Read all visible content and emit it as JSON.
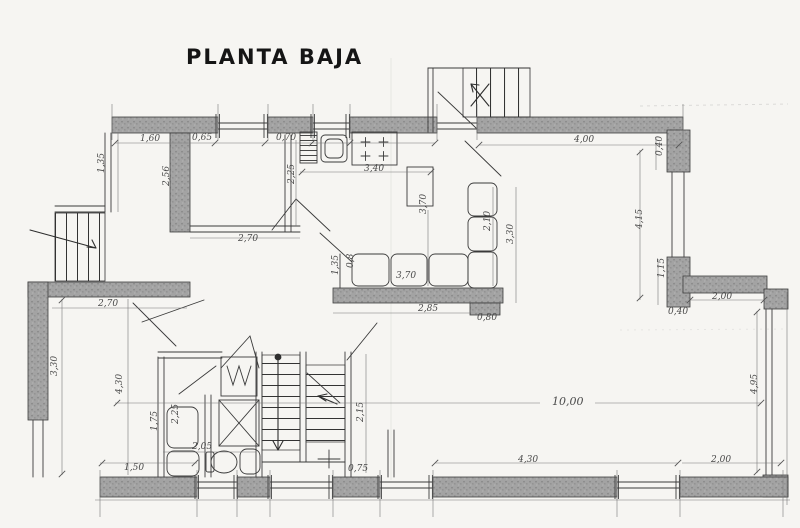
{
  "title": "PLANTA BAJA",
  "drawing": {
    "type": "floor-plan-sketch",
    "floor_label": "PLANTA BAJA",
    "units": "meters (comma decimals)"
  },
  "colors": {
    "paper": "#f6f5f2",
    "ink": "#3a3a3a",
    "wall": "#9b9b9b",
    "dim": "#4a4a4a"
  },
  "labels": {
    "t_1_60": "1,60",
    "t_0_65": "0,65",
    "t_0_70": "0,70",
    "k_3_40": "3,40",
    "t_4_00": "4,00",
    "l_1_35": "1,35",
    "w_2_56": "2,56",
    "k_2_25": "2,25",
    "k_3_70": "3,70",
    "h_2_70": "2,70",
    "s_3_70": "3,70",
    "s_0_80": "0,8",
    "s_1_35": "1,35",
    "d_2_10": "2,10",
    "d_3_30": "3,30",
    "m_2_85": "2,85",
    "m_0_80": "0,80",
    "r_0_40a": "0,40",
    "r_4_15": "4,15",
    "r_1_15": "1,15",
    "r_0_40b": "0,40",
    "r_2_00": "2,00",
    "r_4_95": "4,95",
    "liv_10_00": "10,00",
    "b_4_30": "4,30",
    "b_2_00": "2,00",
    "b_1_50": "1,50",
    "b_0_75": "0,75",
    "st_2_15": "2,15",
    "rm_2_70": "2,70",
    "rm_3_30": "3,30",
    "rm_4_30": "4,30",
    "ba_2_05": "2,05",
    "wd_2_25": "2,25",
    "wd_1_75": "1,75"
  }
}
